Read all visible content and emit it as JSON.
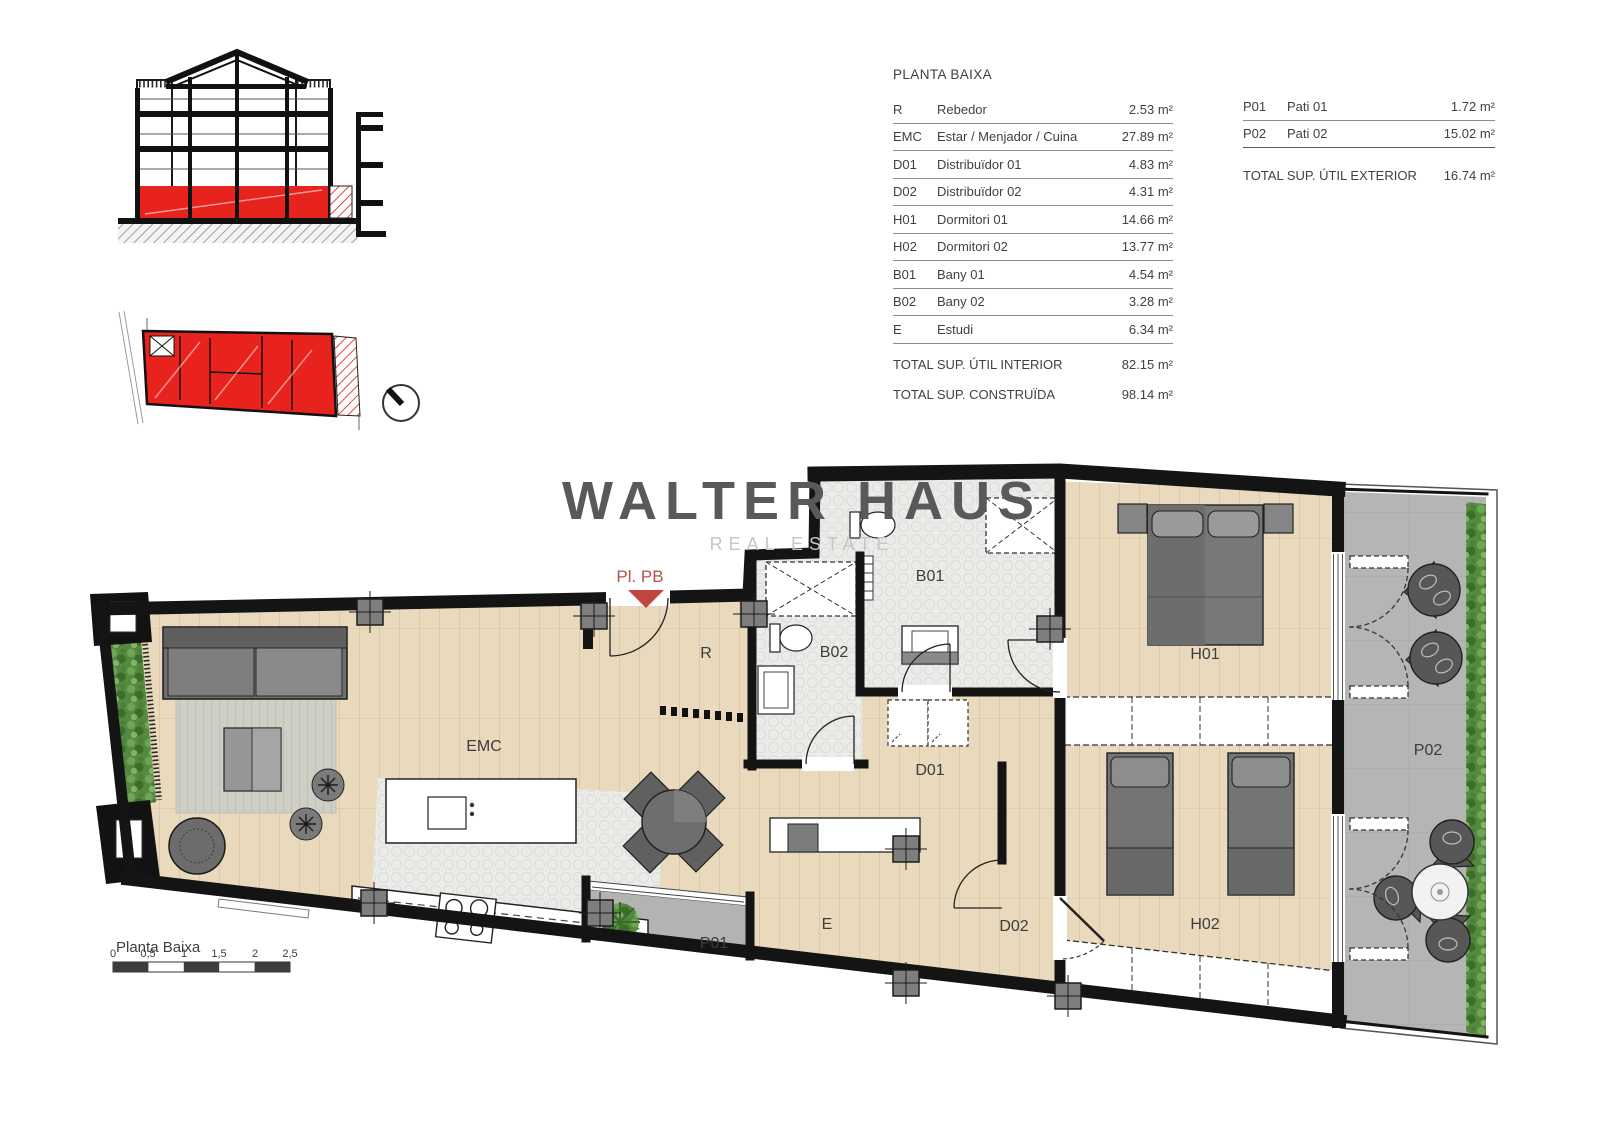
{
  "tables": {
    "interior": {
      "title": "PLANTA BAIXA",
      "rows": [
        {
          "code": "R",
          "name": "Rebedor",
          "area": "2.53 m²"
        },
        {
          "code": "EMC",
          "name": "Estar / Menjador / Cuina",
          "area": "27.89 m²"
        },
        {
          "code": "D01",
          "name": "Distribuïdor 01",
          "area": "4.83 m²"
        },
        {
          "code": "D02",
          "name": "Distribuïdor 02",
          "area": "4.31 m²"
        },
        {
          "code": "H01",
          "name": "Dormitori 01",
          "area": "14.66 m²"
        },
        {
          "code": "H02",
          "name": "Dormitori 02",
          "area": "13.77 m²"
        },
        {
          "code": "B01",
          "name": "Bany 01",
          "area": "4.54 m²"
        },
        {
          "code": "B02",
          "name": "Bany 02",
          "area": "3.28 m²"
        },
        {
          "code": "E",
          "name": "Estudi",
          "area": "6.34 m²"
        }
      ],
      "totals": [
        {
          "label": "TOTAL SUP. ÚTIL INTERIOR",
          "value": "82.15 m²"
        },
        {
          "label": "TOTAL SUP. CONSTRUÏDA",
          "value": "98.14 m²"
        }
      ]
    },
    "exterior": {
      "rows": [
        {
          "code": "P01",
          "name": "Pati 01",
          "area": "1.72 m²"
        },
        {
          "code": "P02",
          "name": "Pati 02",
          "area": "15.02 m²"
        }
      ],
      "total": {
        "label": "TOTAL SUP. ÚTIL EXTERIOR",
        "value": "16.74 m²"
      }
    }
  },
  "watermark": {
    "line1": "WALTER HAUS",
    "line2": "REAL ESTATE"
  },
  "plan": {
    "entrance": "Pl. PB",
    "labels": {
      "r": "R",
      "emc": "EMC",
      "b01": "B01",
      "b02": "B02",
      "d01": "D01",
      "d02": "D02",
      "e": "E",
      "h01": "H01",
      "h02": "H02",
      "p01": "P01",
      "p02": "P02"
    }
  },
  "footer": {
    "caption": "Planta Baixa",
    "scale": [
      "0",
      "0,5",
      "1",
      "1,5",
      "2",
      "2,5"
    ]
  },
  "colors": {
    "highlight_red": "#e8231e",
    "wood": "#e9dabd",
    "patio_gray": "#b5b6b4",
    "entrance_red": "#b3524e",
    "logo_gray": "#58595b"
  }
}
